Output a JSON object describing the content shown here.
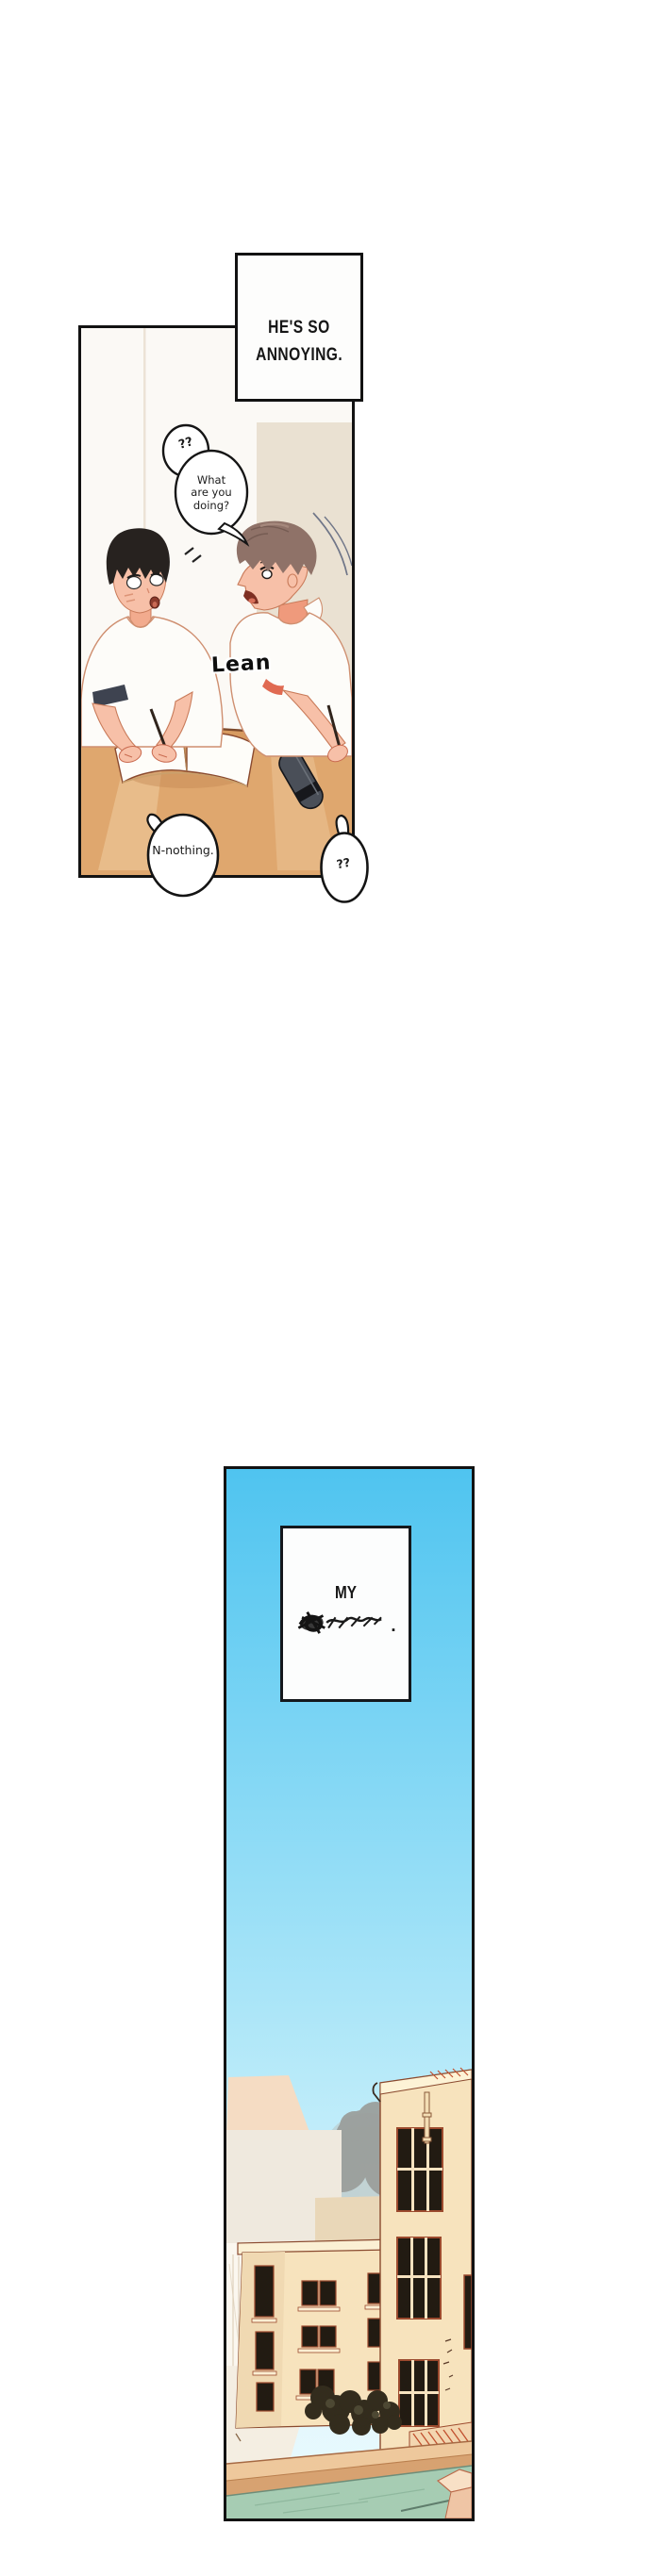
{
  "panel1": {
    "caption_box": {
      "line1": "HE'S SO",
      "line2": "ANNOYING."
    },
    "speech": {
      "question_top": "??",
      "what_line1": "What",
      "what_line2": "are you",
      "what_line3": "doing?",
      "nothing": "N-nothing.",
      "question_bottom": "??"
    },
    "sfx": {
      "lean": "Lean"
    }
  },
  "panel2": {
    "caption_box": {
      "line1": "MY",
      "scribbled_word": true,
      "period": "."
    }
  },
  "colors": {
    "panel_border": "#121212",
    "caption_bg": "#fdfdfc",
    "wall_white": "#fbf9f5",
    "wall_beige": "#eae1d2",
    "desk": "#dfa76e",
    "desk_edge": "#7d4a2c",
    "skin": "#f7c0a8",
    "skin_shadow": "#eb9d80",
    "hair_black": "#27221f",
    "hair_brown": "#8f7268",
    "shirt_white": "#fdfcf9",
    "outline_warm": "#c97b5a",
    "sleeve_trim_red": "#e06a52",
    "pencil_case": "#4a4f58",
    "sky_top": "#4fc4f0",
    "sky_bottom": "#ecfbfe",
    "tree_gray": "#9a9d9a",
    "building_cream": "#f7e3bd",
    "window_dark": "#221b12",
    "line_redbrown": "#9c4a2e",
    "hatch_red": "#c1502e",
    "wall_tan_top": "#eec89c",
    "wall_tan_front": "#d7a271",
    "water_teal": "#a6ccb3",
    "bush_dark": "#332c1d",
    "box_pink_top": "#f8e0c6"
  }
}
